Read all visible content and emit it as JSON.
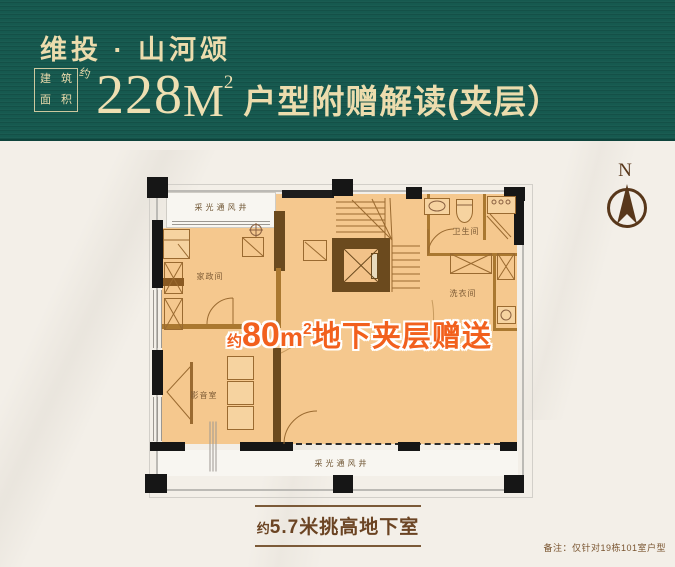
{
  "header": {
    "brand": "维投 · 山河颂",
    "stamp": {
      "c1": "建",
      "c2": "筑",
      "c3": "面",
      "c4": "积",
      "suffix": "约"
    },
    "area_value": "228",
    "area_unit": "M",
    "area_sup": "2",
    "subtitle": "户型附赠解读(夹层）"
  },
  "compass": {
    "label": "N"
  },
  "plan": {
    "vent_top": "采光通风井",
    "vent_bottom": "采光通风井",
    "rooms": {
      "housekeeping": "家政间",
      "bathroom": "卫生间",
      "laundry": "洗衣间",
      "theater": "影音室"
    },
    "gift": {
      "prefix": "约",
      "value": "80",
      "unit": "m",
      "sup": "2",
      "text": "地下夹层赠送"
    }
  },
  "footer": {
    "height_prefix": "约",
    "height_text": "5.7米挑高地下室",
    "note": "备注：仅针对19栋101室户型"
  },
  "colors": {
    "header_bg": "#16594f",
    "gold_text": "#ecdcad",
    "accent_orange": "#f2601d",
    "floor_orange": "#f5c88e",
    "wall_brown": "#6b4a1e",
    "column_black": "#161616",
    "label_brown": "#6b4423"
  }
}
